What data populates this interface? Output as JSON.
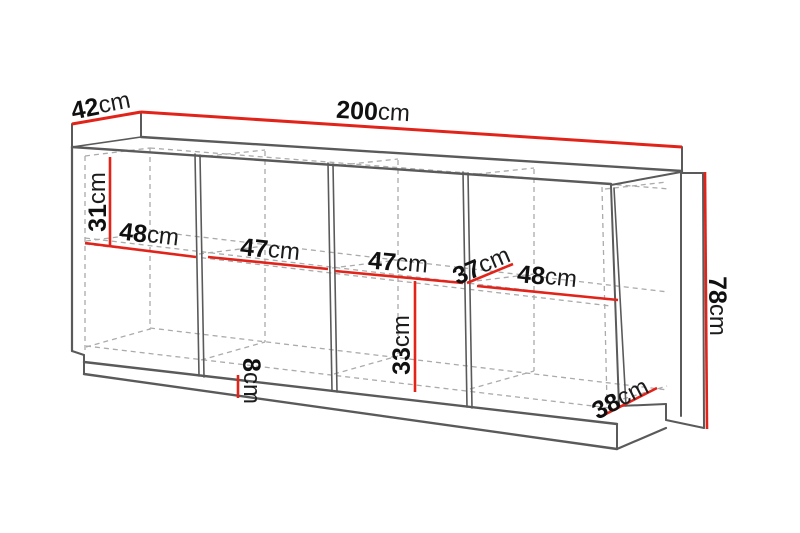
{
  "diagram": {
    "type": "furniture-dimension-diagram",
    "subject": "sideboard-cabinet-wireframe"
  },
  "dimensions": {
    "width": {
      "value": "200",
      "unit": "cm"
    },
    "depth": {
      "value": "42",
      "unit": "cm"
    },
    "height": {
      "value": "78",
      "unit": "cm"
    },
    "section1_width": {
      "value": "48",
      "unit": "cm"
    },
    "section2_width": {
      "value": "47",
      "unit": "cm"
    },
    "section3_width": {
      "value": "47",
      "unit": "cm"
    },
    "section4_width": {
      "value": "48",
      "unit": "cm"
    },
    "upper_compartment_height": {
      "value": "31",
      "unit": "cm"
    },
    "lower_compartment_height": {
      "value": "33",
      "unit": "cm"
    },
    "interior_depth": {
      "value": "37",
      "unit": "cm"
    },
    "base_depth": {
      "value": "38",
      "unit": "cm"
    },
    "plinth_height": {
      "value": "8",
      "unit": "cm"
    }
  },
  "colors": {
    "dimension_line": "#e2231a",
    "outline": "#5a5a5a",
    "hidden_line": "#ababab"
  }
}
